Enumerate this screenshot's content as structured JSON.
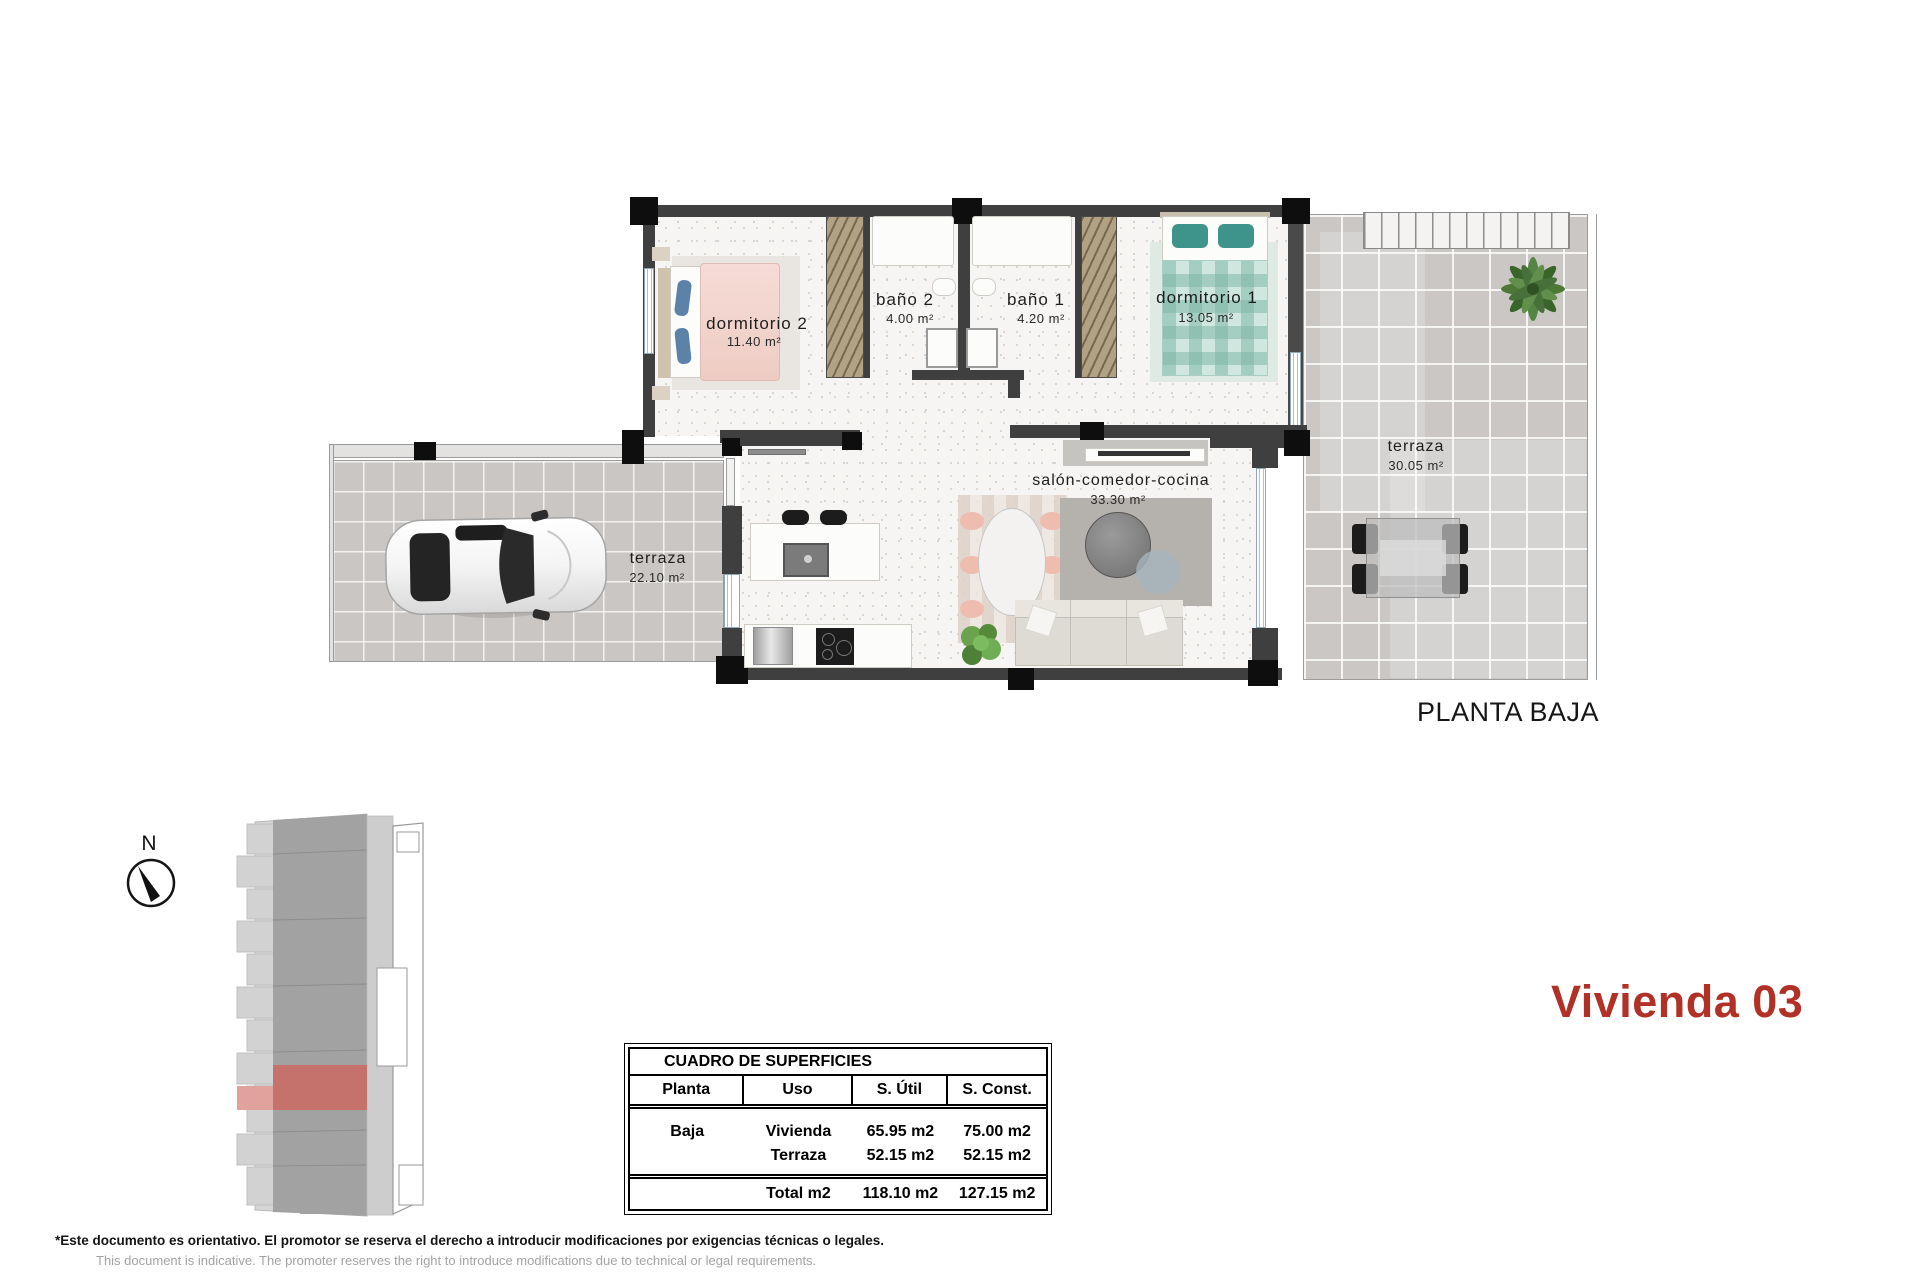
{
  "title": "PLANTA BAJA",
  "unit": "Vivienda 03",
  "compass": {
    "north_label": "N"
  },
  "rooms": {
    "dormitorio2": {
      "name": "dormitorio 2",
      "area": "11.40 m²"
    },
    "bano2": {
      "name": "baño 2",
      "area": "4.00 m²"
    },
    "bano1": {
      "name": "baño 1",
      "area": "4.20 m²"
    },
    "dormitorio1": {
      "name": "dormitorio 1",
      "area": "13.05 m²"
    },
    "terraza_right": {
      "name": "terraza",
      "area": "30.05 m²"
    },
    "terraza_left": {
      "name": "terraza",
      "area": "22.10 m²"
    },
    "salon": {
      "name": "salón-comedor-cocina",
      "area": "33.30 m²"
    }
  },
  "surfaces_table": {
    "title": "CUADRO DE SUPERFICIES",
    "columns": [
      "Planta",
      "Uso",
      "S. Útil",
      "S. Const."
    ],
    "rows": [
      {
        "planta": "Baja",
        "uso": "Vivienda",
        "util": "65.95 m2",
        "construida": "75.00 m2"
      },
      {
        "planta": "",
        "uso": "Terraza",
        "util": "52.15 m2",
        "construida": "52.15 m2"
      }
    ],
    "total": {
      "uso": "Total m2",
      "util": "118.10 m2",
      "construida": "127.15 m2"
    }
  },
  "disclaimer": {
    "es": "*Este documento es orientativo. El promotor se reserva el derecho a introducir modificaciones por exigencias técnicas o legales.",
    "en": "This document is indicative. The promoter reserves the right to introduce modifications due to technical or legal requirements."
  },
  "colors": {
    "accent_red": "#b23127",
    "site_highlight": "#c5726c",
    "wall": "#3f3f3f"
  }
}
